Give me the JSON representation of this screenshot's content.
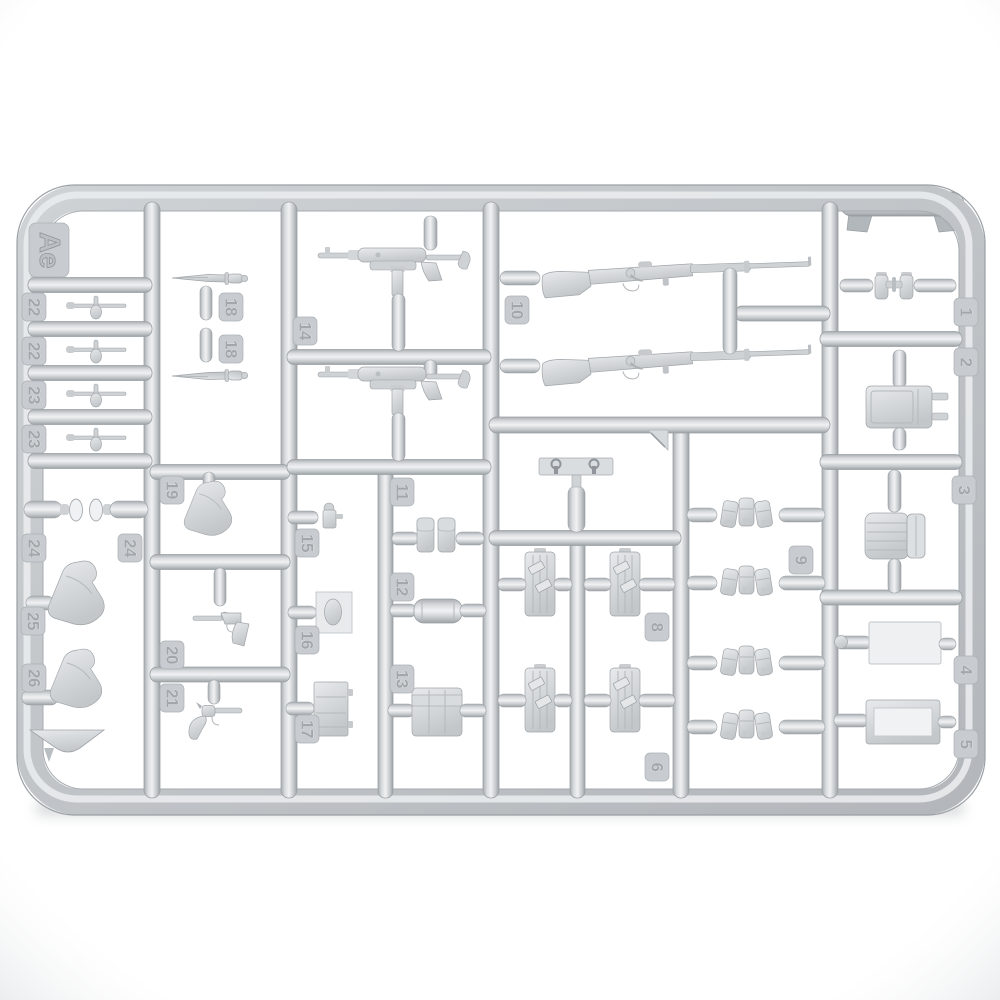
{
  "photo": {
    "description": "Top-down photograph of a light gray injection-molded plastic model kit sprue, frame Ae, holding small WWII German infantry weapon and equipment parts with embossed number tags",
    "sprue_letter": "Ae"
  },
  "colors": {
    "background": "#ffffff",
    "plastic_light": "#eff1f2",
    "plastic_mid": "#c9cdd0",
    "plastic_dark": "#9aa0a4",
    "shadow": "#878d92"
  },
  "tags": [
    {
      "label": "Ae",
      "part": "sprue-letter-tab"
    },
    {
      "label": "22",
      "part": "small-tool"
    },
    {
      "label": "22",
      "part": "small-tool"
    },
    {
      "label": "23",
      "part": "small-tool"
    },
    {
      "label": "23",
      "part": "small-tool"
    },
    {
      "label": "24",
      "part": "lens-disc"
    },
    {
      "label": "24",
      "part": "lens-disc"
    },
    {
      "label": "25",
      "part": "holster"
    },
    {
      "label": "26",
      "part": "holster-with-cone-base"
    },
    {
      "label": "18",
      "part": "bayonet"
    },
    {
      "label": "18",
      "part": "bayonet"
    },
    {
      "label": "19",
      "part": "holster"
    },
    {
      "label": "20",
      "part": "pistol"
    },
    {
      "label": "21",
      "part": "revolver"
    },
    {
      "label": "14",
      "part": "mp40-smg"
    },
    {
      "label": "15",
      "part": "small-grenade-part"
    },
    {
      "label": "16",
      "part": "carrier-plate"
    },
    {
      "label": "17",
      "part": "ammo-crate"
    },
    {
      "label": "11",
      "part": "double-magazine-pouch"
    },
    {
      "label": "12",
      "part": "cylindrical-container"
    },
    {
      "label": "13",
      "part": "large-pouch-set"
    },
    {
      "label": "10",
      "part": "kar98k-rifle"
    },
    {
      "label": "8",
      "part": "equipment-board"
    },
    {
      "label": "6",
      "part": "equipment-board"
    },
    {
      "label": "9",
      "part": "triple-magazine-pouch"
    },
    {
      "label": "1",
      "part": "binoculars"
    },
    {
      "label": "2",
      "part": "canister-with-prongs"
    },
    {
      "label": "3",
      "part": "ribbed-canister"
    },
    {
      "label": "4",
      "part": "flat-plate"
    },
    {
      "label": "5",
      "part": "rectangular-tray"
    }
  ],
  "parts_summary": [
    {
      "name": "kar98k-rifle",
      "tag": "10",
      "count": 2
    },
    {
      "name": "mp40-smg",
      "tag": "14",
      "count": 2
    },
    {
      "name": "bayonet",
      "tag": "18",
      "count": 2
    },
    {
      "name": "pistol",
      "tag": "20",
      "count": 1
    },
    {
      "name": "revolver",
      "tag": "21",
      "count": 1
    },
    {
      "name": "holster",
      "tag": "19/25/26",
      "count": 3
    },
    {
      "name": "small-tool",
      "tag": "22/23",
      "count": 4
    },
    {
      "name": "lens-disc",
      "tag": "24",
      "count": 2
    },
    {
      "name": "equipment-board",
      "tag": "8/6",
      "count": 4
    },
    {
      "name": "triple-magazine-pouch",
      "tag": "9",
      "count": 4
    },
    {
      "name": "strap-buckle-bar",
      "tag": "",
      "count": 1
    },
    {
      "name": "binoculars",
      "tag": "1",
      "count": 1
    }
  ]
}
